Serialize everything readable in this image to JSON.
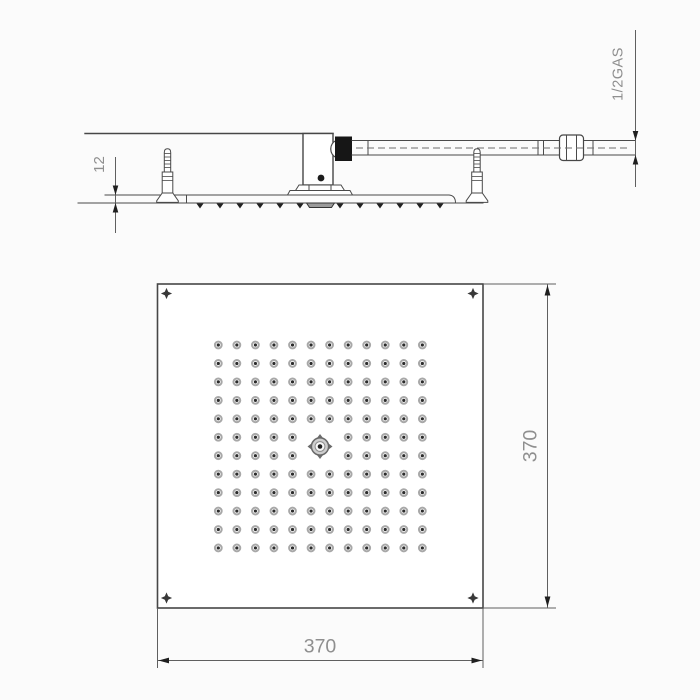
{
  "side_view": {
    "plate_thickness_label": "12",
    "connection_label": "1/2GAS"
  },
  "bottom_view": {
    "width_label": "370",
    "height_label": "370",
    "nozzle_grid": {
      "rows": 12,
      "cols": 12,
      "center_positions_replaced_by_hub": 4,
      "total_nozzles": 140
    },
    "corner_screw_count": 4
  },
  "colors": {
    "line": "#474747",
    "dim_text": "#8f8f8f",
    "connector": "#161616",
    "nozzle_ring": "#a8a8a8",
    "nozzle_center": "#2b2b2b",
    "background": "#fbfbfb"
  }
}
